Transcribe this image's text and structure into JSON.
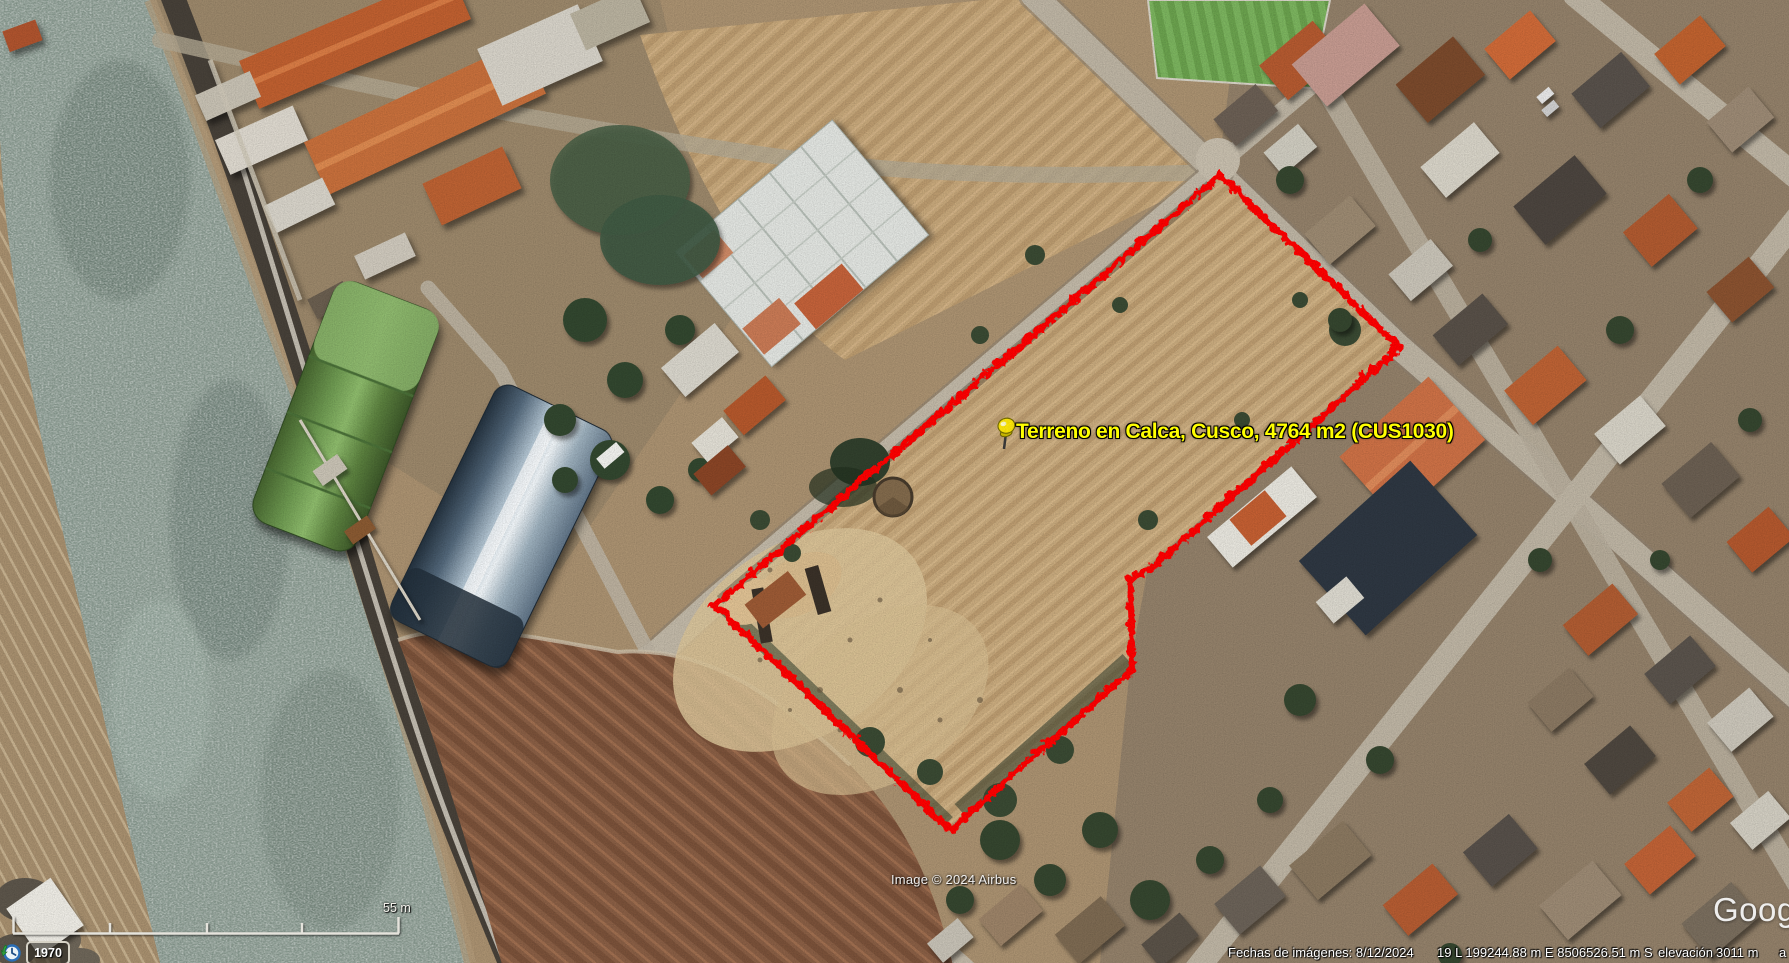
{
  "placemark": {
    "label": "Terreno en Calca, Cusco, 4764 m2 (CUS1030)",
    "label_color": "#ffff00",
    "icon": "yellow-pushpin"
  },
  "parcel_outline": {
    "color": "#ff0000",
    "style": "jagged-solid"
  },
  "attribution": {
    "text": "Image © 2024 Airbus"
  },
  "status_bar": {
    "imagery_date": "Fechas de imágenes: 8/12/2024",
    "utm_coordinates": "19 L 199244.88 m E 8506526.51 m S",
    "elevation_label": "elevación",
    "elevation_value": "3011 m",
    "right_truncated_text": "a"
  },
  "scale_bar": {
    "label": "55 m"
  },
  "time_slider": {
    "year": "1970",
    "icon": "history-clock-icon"
  },
  "watermark": {
    "text": "Goog"
  }
}
